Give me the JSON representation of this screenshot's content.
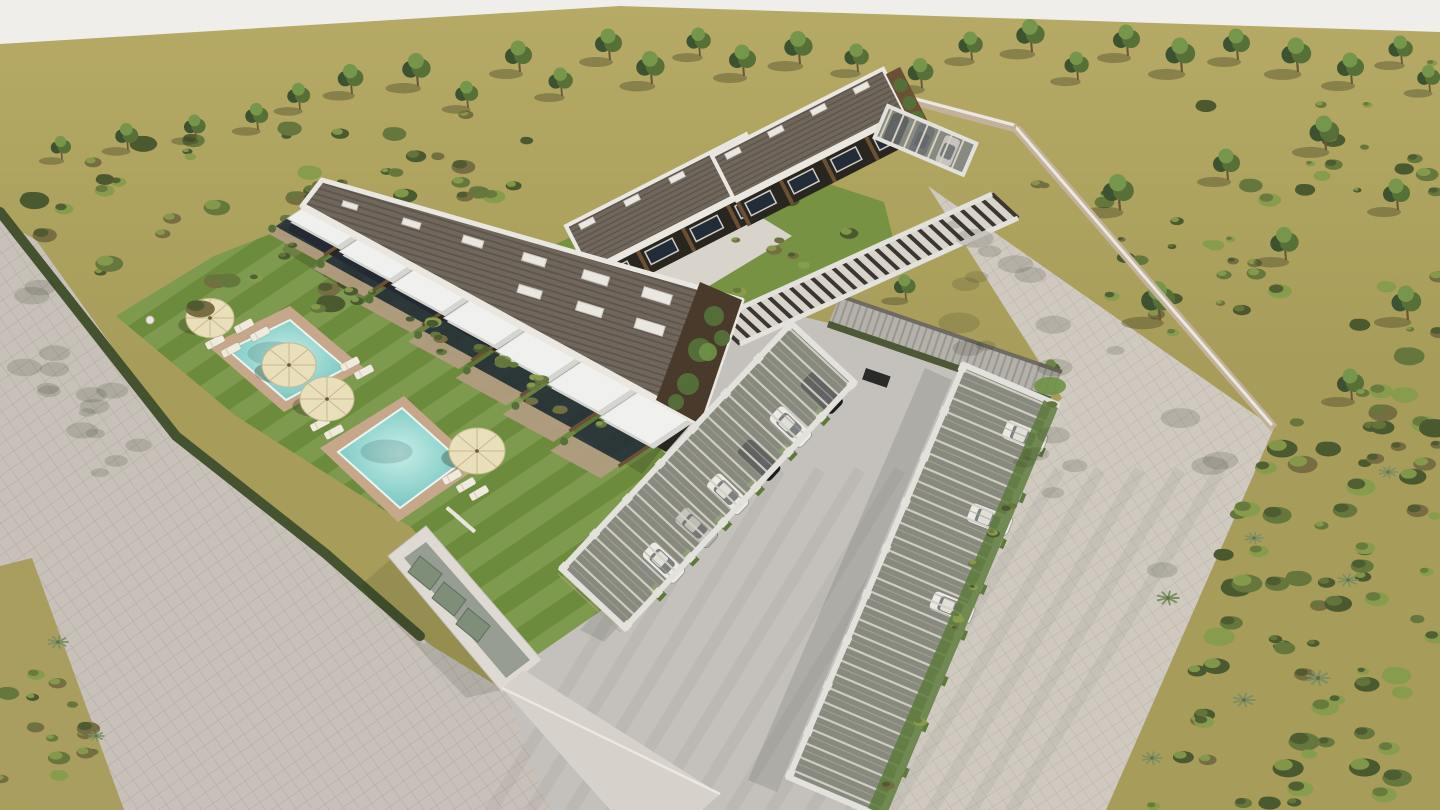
{
  "colors": {
    "sky": "#f0eeeb",
    "field": "#a89c5a",
    "fieldLight": "#b6aa66",
    "road": "#c7c1b9",
    "roadLine": "#a59e96",
    "plaza": "#cfc9c0",
    "plazaLine": "#b3aba1",
    "concrete": "#c4c1bc",
    "lawn": "#71903f",
    "deck": "#c6a78b",
    "waterEdge": "#6fbdba",
    "waterMid": "#8fd2cc",
    "waterLight": "#c6eee6",
    "hedge": "#44522f",
    "scrubDark": "#4b5930",
    "scrubMid": "#66773d",
    "scrubLight": "#879c4d",
    "scrubBrown": "#776d43",
    "treeDark": "#3d5230",
    "treeMid": "#567038",
    "treeLight": "#76974b",
    "trunk": "#6b5638",
    "shadow": "rgba(50,52,28,0.33)",
    "roofTile": "#6f665c",
    "roofStripe": "#594f47",
    "parapet": "#eae7e1",
    "facade": "#29251f",
    "wood": "#6b5036",
    "glass": "#222c38",
    "awning": "#f0f1ee",
    "awningShade": "#d5d6d1",
    "ivy": "#55713a",
    "ivyLight": "#6e9246",
    "frame": "#e3e1db",
    "beam": "#d7d0c0",
    "beamWood": "#b3a184",
    "inner": "#53584e",
    "glassRoof": "rgba(228,232,226,0.35)",
    "wallBeige": "#c3b29b",
    "wallCap": "#ece8e0",
    "ramp": "#b4b0aa",
    "rampLine": "#908c85",
    "meshHedge": "#4c5836",
    "carWhite": "#eceae6",
    "carBlack": "#1b1c1e",
    "carSilver": "#b5b0a8",
    "carDark": "#33363b",
    "umbrella": "#e9dfba",
    "umbrellaRib": "#c6b992",
    "lounger": "#efeadb",
    "equip": "#7e8e79",
    "poolhouse": "#ded9d2",
    "poolhouseInner": "#979d93",
    "grassStrip": "#5d7a3c"
  },
  "terrain": {
    "skyPoly": [
      [
        0,
        0
      ],
      [
        1440,
        0
      ],
      [
        1440,
        32
      ],
      [
        620,
        6
      ],
      [
        0,
        44
      ]
    ],
    "roadPoly": [
      [
        0,
        220
      ],
      [
        36,
        240
      ],
      [
        182,
        444
      ],
      [
        330,
        562
      ],
      [
        432,
        646
      ],
      [
        520,
        700
      ],
      [
        614,
        810
      ],
      [
        0,
        810
      ]
    ],
    "vergePoly": [
      [
        0,
        566
      ],
      [
        32,
        558
      ],
      [
        124,
        810
      ],
      [
        0,
        810
      ]
    ],
    "plazaPoly": [
      [
        928,
        186
      ],
      [
        1274,
        428
      ],
      [
        1106,
        810
      ],
      [
        846,
        810
      ],
      [
        1000,
        462
      ],
      [
        1062,
        398
      ]
    ],
    "concretePoly": [
      [
        566,
        306
      ],
      [
        744,
        302
      ],
      [
        1010,
        368
      ],
      [
        1052,
        402
      ],
      [
        986,
        470
      ],
      [
        850,
        810
      ],
      [
        550,
        810
      ],
      [
        498,
        672
      ],
      [
        414,
        530
      ],
      [
        520,
        430
      ]
    ],
    "lawnPoly": [
      [
        116,
        316
      ],
      [
        214,
        256
      ],
      [
        332,
        210
      ],
      [
        402,
        246
      ],
      [
        644,
        434
      ],
      [
        702,
        486
      ],
      [
        628,
        592
      ],
      [
        518,
        668
      ],
      [
        412,
        528
      ],
      [
        236,
        416
      ]
    ],
    "backGardenPoly": [
      [
        556,
        244
      ],
      [
        744,
        156
      ],
      [
        884,
        202
      ],
      [
        898,
        258
      ],
      [
        760,
        326
      ],
      [
        618,
        318
      ]
    ],
    "pathPoly": [
      [
        590,
        304
      ],
      [
        756,
        214
      ],
      [
        792,
        236
      ],
      [
        636,
        330
      ]
    ],
    "hedgePts": [
      [
        0,
        212
      ],
      [
        176,
        436
      ],
      [
        326,
        554
      ],
      [
        420,
        636
      ]
    ],
    "grassStripR": [
      [
        1058,
        408
      ],
      [
        886,
        816
      ],
      [
        868,
        808
      ],
      [
        1044,
        400
      ]
    ],
    "streaks": {
      "count": 14,
      "x0": 490,
      "dx": 40
    }
  },
  "poolhouse": {
    "outer": [
      [
        388,
        556
      ],
      [
        426,
        526
      ],
      [
        542,
        660
      ],
      [
        502,
        692
      ]
    ],
    "inner": [
      [
        404,
        558
      ],
      [
        426,
        542
      ],
      [
        530,
        660
      ],
      [
        506,
        678
      ]
    ],
    "units": [
      [
        [
          420,
          556
        ],
        [
          442,
          574
        ],
        [
          430,
          590
        ],
        [
          408,
          572
        ]
      ],
      [
        [
          444,
          582
        ],
        [
          466,
          600
        ],
        [
          454,
          616
        ],
        [
          432,
          598
        ]
      ],
      [
        [
          468,
          608
        ],
        [
          490,
          626
        ],
        [
          478,
          642
        ],
        [
          456,
          624
        ]
      ]
    ],
    "wallBand": [
      [
        502,
        688
      ],
      [
        524,
        670
      ],
      [
        720,
        794
      ],
      [
        700,
        812
      ],
      [
        612,
        812
      ]
    ]
  },
  "b1": {
    "roof": [
      [
        322,
        180
      ],
      [
        742,
        300
      ],
      [
        700,
        424
      ],
      [
        302,
        206
      ]
    ],
    "backEdge": [
      322,
      180,
      742,
      300
    ],
    "frontLine": [
      302,
      206,
      694,
      420
    ],
    "units": 7,
    "facade": [
      [
        302,
        206
      ],
      [
        694,
        420
      ],
      [
        666,
        452
      ],
      [
        288,
        230
      ]
    ],
    "end": [
      [
        742,
        300
      ],
      [
        700,
        424
      ],
      [
        656,
        400
      ],
      [
        700,
        282
      ]
    ],
    "skyRowA": {
      "n": 7,
      "t0": 0.06,
      "t1": 0.92,
      "off": 14
    },
    "skyRowB": {
      "n": 4,
      "t0": 0.5,
      "t1": 0.92,
      "off": 46
    }
  },
  "backBlocks": [
    {
      "x": 566,
      "y": 226,
      "angle": -27,
      "len": 202,
      "roofD": 50,
      "facD": 26,
      "units": 4
    },
    {
      "x": 712,
      "y": 156,
      "angle": -27,
      "len": 192,
      "roofD": 48,
      "facD": 26,
      "units": 4
    }
  ],
  "walkway": {
    "band": [
      [
        992,
        194
      ],
      [
        1018,
        218
      ],
      [
        740,
        344
      ],
      [
        714,
        320
      ]
    ],
    "slats": 26
  },
  "ramp": {
    "poly": [
      [
        840,
        296
      ],
      [
        1062,
        372
      ],
      [
        1050,
        400
      ],
      [
        828,
        324
      ]
    ],
    "topEdge": [
      840,
      296,
      1062,
      372
    ],
    "hedgeEdge": [
      828,
      324,
      1050,
      400
    ],
    "slot": [
      866,
      368
    ]
  },
  "walls": {
    "plazaWall": [
      1016,
      128,
      1274,
      428
    ],
    "topWall": [
      880,
      92,
      1016,
      128
    ]
  },
  "carports": [
    {
      "x": 854,
      "y": 382,
      "angle": 133,
      "len": 336,
      "w": 86,
      "bays": 7,
      "cars": [
        {
          "lx": 30,
          "c": "carBlack"
        },
        {
          "lx": 76,
          "c": "carWhite"
        },
        {
          "lx": 122,
          "c": "carBlack"
        },
        {
          "lx": 168,
          "c": "carWhite"
        },
        {
          "lx": 214,
          "c": "carSilver"
        },
        {
          "lx": 262,
          "c": "carWhite"
        }
      ]
    },
    {
      "x": 1056,
      "y": 404,
      "angle": 113,
      "len": 448,
      "w": 100,
      "bays": 9,
      "cars": [
        {
          "lx": 42,
          "c": "carWhite"
        },
        {
          "lx": 132,
          "c": "carWhite"
        },
        {
          "lx": 228,
          "c": "carWhite"
        }
      ]
    }
  ],
  "carport3": {
    "x": 888,
    "y": 106,
    "angle": 23,
    "len": 96,
    "w": 34,
    "bays": 3,
    "cars": [
      {
        "lx": 16,
        "c": "carBlack"
      },
      {
        "lx": 44,
        "c": "carDark"
      },
      {
        "lx": 72,
        "c": "carSilver"
      }
    ]
  },
  "pools": [
    {
      "deck": [
        [
          208,
          346
        ],
        [
          290,
          306
        ],
        [
          364,
          368
        ],
        [
          284,
          412
        ]
      ],
      "water": [
        [
          228,
          350
        ],
        [
          290,
          320
        ],
        [
          346,
          368
        ],
        [
          286,
          400
        ]
      ]
    },
    {
      "deck": [
        [
          320,
          448
        ],
        [
          404,
          396
        ],
        [
          480,
          466
        ],
        [
          398,
          522
        ]
      ],
      "water": [
        [
          338,
          452
        ],
        [
          402,
          408
        ],
        [
          462,
          462
        ],
        [
          400,
          508
        ]
      ]
    }
  ],
  "steps": [
    [
      448,
      506
    ],
    [
      456,
      513
    ],
    [
      464,
      520
    ]
  ],
  "umbrellas": [
    [
      210,
      318,
      24
    ],
    [
      289,
      365,
      27
    ],
    [
      327,
      399,
      27
    ],
    [
      477,
      451,
      28
    ]
  ],
  "loungers": [
    [
      244,
      326,
      -28
    ],
    [
      260,
      334,
      -28
    ],
    [
      215,
      342,
      -28
    ],
    [
      231,
      350,
      -28
    ],
    [
      350,
      364,
      -28
    ],
    [
      364,
      372,
      -28
    ],
    [
      320,
      424,
      -28
    ],
    [
      334,
      432,
      -28
    ],
    [
      452,
      477,
      -30
    ],
    [
      466,
      485,
      -30
    ],
    [
      479,
      493,
      -30
    ]
  ],
  "shower": [
    150,
    320
  ],
  "trees": [
    [
      300,
      108,
      0.85
    ],
    [
      352,
      92,
      0.95
    ],
    [
      418,
      84,
      1.05
    ],
    [
      468,
      106,
      0.85
    ],
    [
      520,
      70,
      1.0
    ],
    [
      562,
      94,
      0.9
    ],
    [
      610,
      58,
      1.0
    ],
    [
      652,
      82,
      1.05
    ],
    [
      700,
      54,
      0.9
    ],
    [
      744,
      74,
      1.0
    ],
    [
      800,
      62,
      1.05
    ],
    [
      858,
      70,
      0.9
    ],
    [
      922,
      86,
      0.95
    ],
    [
      972,
      58,
      0.9
    ],
    [
      1032,
      50,
      1.05
    ],
    [
      1078,
      78,
      0.9
    ],
    [
      1128,
      54,
      1.0
    ],
    [
      1182,
      70,
      1.1
    ],
    [
      1238,
      58,
      1.0
    ],
    [
      1298,
      70,
      1.1
    ],
    [
      1352,
      82,
      1.0
    ],
    [
      1402,
      62,
      0.9
    ],
    [
      1430,
      90,
      0.85
    ],
    [
      62,
      158,
      0.75
    ],
    [
      128,
      148,
      0.85
    ],
    [
      196,
      138,
      0.8
    ],
    [
      258,
      128,
      0.85
    ],
    [
      1120,
      208,
      1.15
    ],
    [
      1228,
      178,
      1.0
    ],
    [
      1326,
      148,
      1.1
    ],
    [
      1398,
      208,
      1.0
    ],
    [
      1160,
      318,
      1.25
    ],
    [
      1286,
      258,
      1.05
    ],
    [
      1408,
      318,
      1.1
    ],
    [
      1352,
      398,
      1.0
    ],
    [
      906,
      298,
      0.8
    ],
    [
      1052,
      380,
      0.7
    ]
  ],
  "agaves": [
    [
      58,
      642,
      1.1
    ],
    [
      96,
      736,
      0.9
    ],
    [
      1168,
      598,
      1.2
    ],
    [
      1254,
      538,
      1.0
    ],
    [
      1318,
      678,
      1.3
    ],
    [
      1152,
      758,
      1.1
    ],
    [
      1388,
      472,
      1.0
    ],
    [
      1244,
      700,
      1.2
    ],
    [
      1348,
      580,
      1.1
    ]
  ],
  "scatters": [
    {
      "name": "left-scrub-band",
      "poly": [
        [
          0,
          128
        ],
        [
          330,
          96
        ],
        [
          600,
          112
        ],
        [
          544,
          198
        ],
        [
          318,
          330
        ],
        [
          150,
          308
        ],
        [
          0,
          224
        ]
      ],
      "count": 60,
      "seed": 7,
      "kind": "shrub",
      "smin": 5,
      "smax": 15,
      "layer": "back"
    },
    {
      "name": "verge-scrub",
      "poly": [
        [
          0,
          566
        ],
        [
          34,
          558
        ],
        [
          124,
          810
        ],
        [
          0,
          810
        ]
      ],
      "count": 14,
      "seed": 3,
      "kind": "shrub",
      "smin": 5,
      "smax": 12,
      "layer": "front"
    },
    {
      "name": "field-shrubs-right",
      "poly": [
        [
          980,
          150
        ],
        [
          1440,
          44
        ],
        [
          1440,
          324
        ],
        [
          1286,
          424
        ],
        [
          1056,
          258
        ]
      ],
      "count": 46,
      "seed": 11,
      "kind": "shrub",
      "smin": 4,
      "smax": 12,
      "layer": "back"
    },
    {
      "name": "right-scrub-band",
      "poly": [
        [
          1274,
          428
        ],
        [
          1440,
          326
        ],
        [
          1440,
          810
        ],
        [
          1108,
          810
        ]
      ],
      "count": 80,
      "seed": 5,
      "kind": "shrub",
      "smin": 6,
      "smax": 16,
      "layer": "front"
    },
    {
      "name": "back-garden-shrubs",
      "poly": [
        [
          560,
          244
        ],
        [
          744,
          156
        ],
        [
          880,
          202
        ],
        [
          894,
          258
        ],
        [
          762,
          326
        ],
        [
          622,
          318
        ]
      ],
      "count": 16,
      "seed": 9,
      "kind": "shrub",
      "smin": 4,
      "smax": 10,
      "layer": "back"
    },
    {
      "name": "garden-border-shrubs",
      "poly": [
        [
          292,
          240
        ],
        [
          640,
          430
        ],
        [
          620,
          452
        ],
        [
          280,
          262
        ]
      ],
      "count": 22,
      "seed": 21,
      "kind": "shrub",
      "smin": 4,
      "smax": 9,
      "layer": "front"
    },
    {
      "name": "carportR-hedge",
      "poly": [
        [
          1058,
          408
        ],
        [
          886,
          816
        ],
        [
          868,
          808
        ],
        [
          1044,
          400
        ]
      ],
      "count": 12,
      "seed": 27,
      "kind": "shrub",
      "smin": 3,
      "smax": 7,
      "layer": "front"
    },
    {
      "name": "plaza-dapple",
      "poly": [
        [
          940,
          210
        ],
        [
          1250,
          420
        ],
        [
          1150,
          600
        ],
        [
          960,
          430
        ]
      ],
      "count": 22,
      "seed": 13,
      "kind": "dapple",
      "smin": 8,
      "smax": 22,
      "layer": "fx"
    },
    {
      "name": "road-dapple",
      "poly": [
        [
          0,
          230
        ],
        [
          170,
          440
        ],
        [
          120,
          520
        ],
        [
          0,
          330
        ]
      ],
      "count": 16,
      "seed": 17,
      "kind": "dapple",
      "smin": 8,
      "smax": 20,
      "layer": "fx"
    }
  ],
  "shadows": [
    {
      "poly": [
        [
          296,
          228
        ],
        [
          664,
          446
        ],
        [
          642,
          474
        ],
        [
          282,
          250
        ]
      ],
      "o": 0.2
    },
    {
      "poly": [
        [
          832,
          396
        ],
        [
          604,
          642
        ],
        [
          580,
          630
        ],
        [
          808,
          382
        ]
      ],
      "o": 0.13
    },
    {
      "poly": [
        [
          952,
          380
        ],
        [
          777,
          792
        ],
        [
          748,
          780
        ],
        [
          925,
          368
        ]
      ],
      "o": 0.13
    },
    {
      "poly": [
        [
          986,
          214
        ],
        [
          712,
          338
        ],
        [
          702,
          324
        ],
        [
          976,
          200
        ]
      ],
      "o": 0.14
    },
    {
      "poly": [
        [
          390,
          560
        ],
        [
          360,
          586
        ],
        [
          466,
          698
        ],
        [
          502,
          690
        ]
      ],
      "o": 0.12
    }
  ]
}
